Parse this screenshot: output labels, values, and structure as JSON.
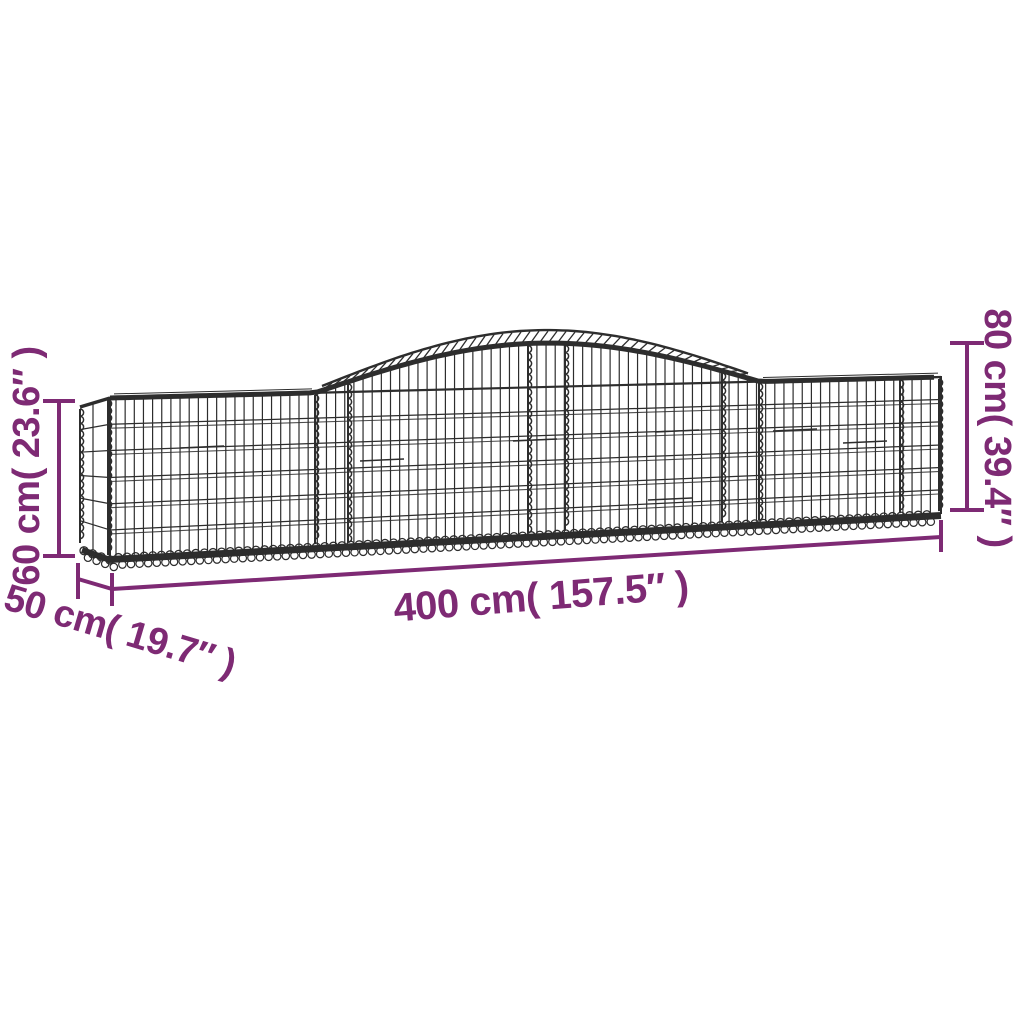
{
  "colors": {
    "dimension_accent": "#7E2A74",
    "wire": "#2d2d2d",
    "background": "#ffffff"
  },
  "dimensions": {
    "height_left": {
      "label": "60 cm( 23.6″ )"
    },
    "height_right": {
      "label": "80 cm( 39.4″ )"
    },
    "length": {
      "label": "400 cm( 157.5″ )"
    },
    "depth": {
      "label": "50 cm( 19.7″ )"
    }
  }
}
